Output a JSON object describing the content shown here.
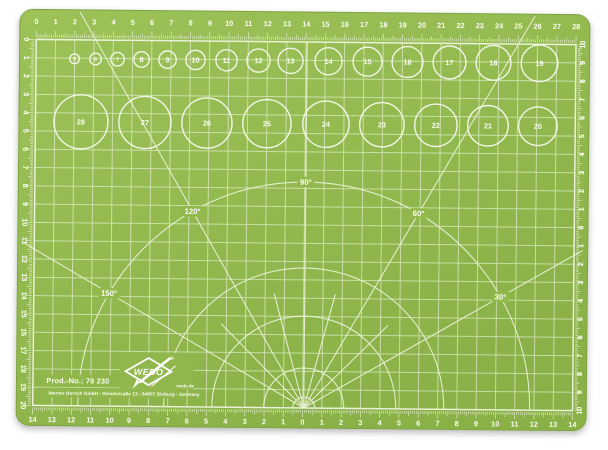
{
  "mat": {
    "color": "#92b94d",
    "color_light": "#9cc258",
    "color_dark": "#89b147",
    "line_color": "#f2f6e3",
    "text_color": "#fbfdf2"
  },
  "rulers": {
    "top": [
      "0",
      "1",
      "2",
      "3",
      "4",
      "5",
      "6",
      "7",
      "8",
      "9",
      "10",
      "11",
      "12",
      "13",
      "14",
      "15",
      "16",
      "17",
      "18",
      "19",
      "20",
      "21",
      "22",
      "23",
      "24",
      "25",
      "26",
      "27",
      "28"
    ],
    "left": [
      "0",
      "1",
      "2",
      "3",
      "4",
      "5",
      "6",
      "7",
      "8",
      "9",
      "10",
      "11",
      "12",
      "13",
      "14",
      "15",
      "16",
      "17",
      "18",
      "19",
      "20"
    ],
    "bottom": [
      "14",
      "13",
      "12",
      "11",
      "10",
      "9",
      "8",
      "7",
      "6",
      "5",
      "4",
      "3",
      "2",
      "1",
      "0",
      "1",
      "2",
      "3",
      "4",
      "5",
      "6",
      "7",
      "8",
      "9",
      "10",
      "11",
      "12",
      "13",
      "14"
    ],
    "right": [
      "10",
      "9",
      "8",
      "7",
      "6",
      "5",
      "4",
      "3",
      "2",
      "1",
      "0",
      "1",
      "2",
      "3",
      "4",
      "5",
      "6",
      "7",
      "8",
      "9",
      "10"
    ]
  },
  "circle_templates": {
    "row1": [
      {
        "label": "5",
        "cx": 73
      },
      {
        "label": "6",
        "cx": 94
      },
      {
        "label": "7",
        "cx": 116
      },
      {
        "label": "8",
        "cx": 140
      },
      {
        "label": "9",
        "cx": 166
      },
      {
        "label": "10",
        "cx": 194
      },
      {
        "label": "11",
        "cx": 225
      },
      {
        "label": "12",
        "cx": 257
      },
      {
        "label": "13",
        "cx": 289
      },
      {
        "label": "14",
        "cx": 327
      },
      {
        "label": "15",
        "cx": 366
      },
      {
        "label": "16",
        "cx": 406
      },
      {
        "label": "17",
        "cx": 448
      },
      {
        "label": "18",
        "cx": 492
      },
      {
        "label": "19",
        "cx": 538
      }
    ],
    "row2": [
      {
        "label": "28",
        "cx": 80
      },
      {
        "label": "27",
        "cx": 144
      },
      {
        "label": "26",
        "cx": 206
      },
      {
        "label": "25",
        "cx": 266
      },
      {
        "label": "24",
        "cx": 325
      },
      {
        "label": "23",
        "cx": 381
      },
      {
        "label": "22",
        "cx": 435
      },
      {
        "label": "21",
        "cx": 487
      },
      {
        "label": "20",
        "cx": 537
      }
    ]
  },
  "protractor": {
    "labeled_angles": [
      "30°",
      "60°",
      "90°",
      "120°",
      "150°"
    ],
    "minor_angles": [
      45,
      75,
      105,
      135
    ],
    "arc_radii": [
      11,
      40,
      92,
      140,
      226
    ],
    "label_radius": 226
  },
  "branding": {
    "prod_no": "Prod.-No.: 79 230",
    "address": "Werner Dorsch GmbH - Dieselstraße 13 - 64807 Dieburg - Germany",
    "logo": "WEDO",
    "reg": "®",
    "site": "wedo.de"
  }
}
